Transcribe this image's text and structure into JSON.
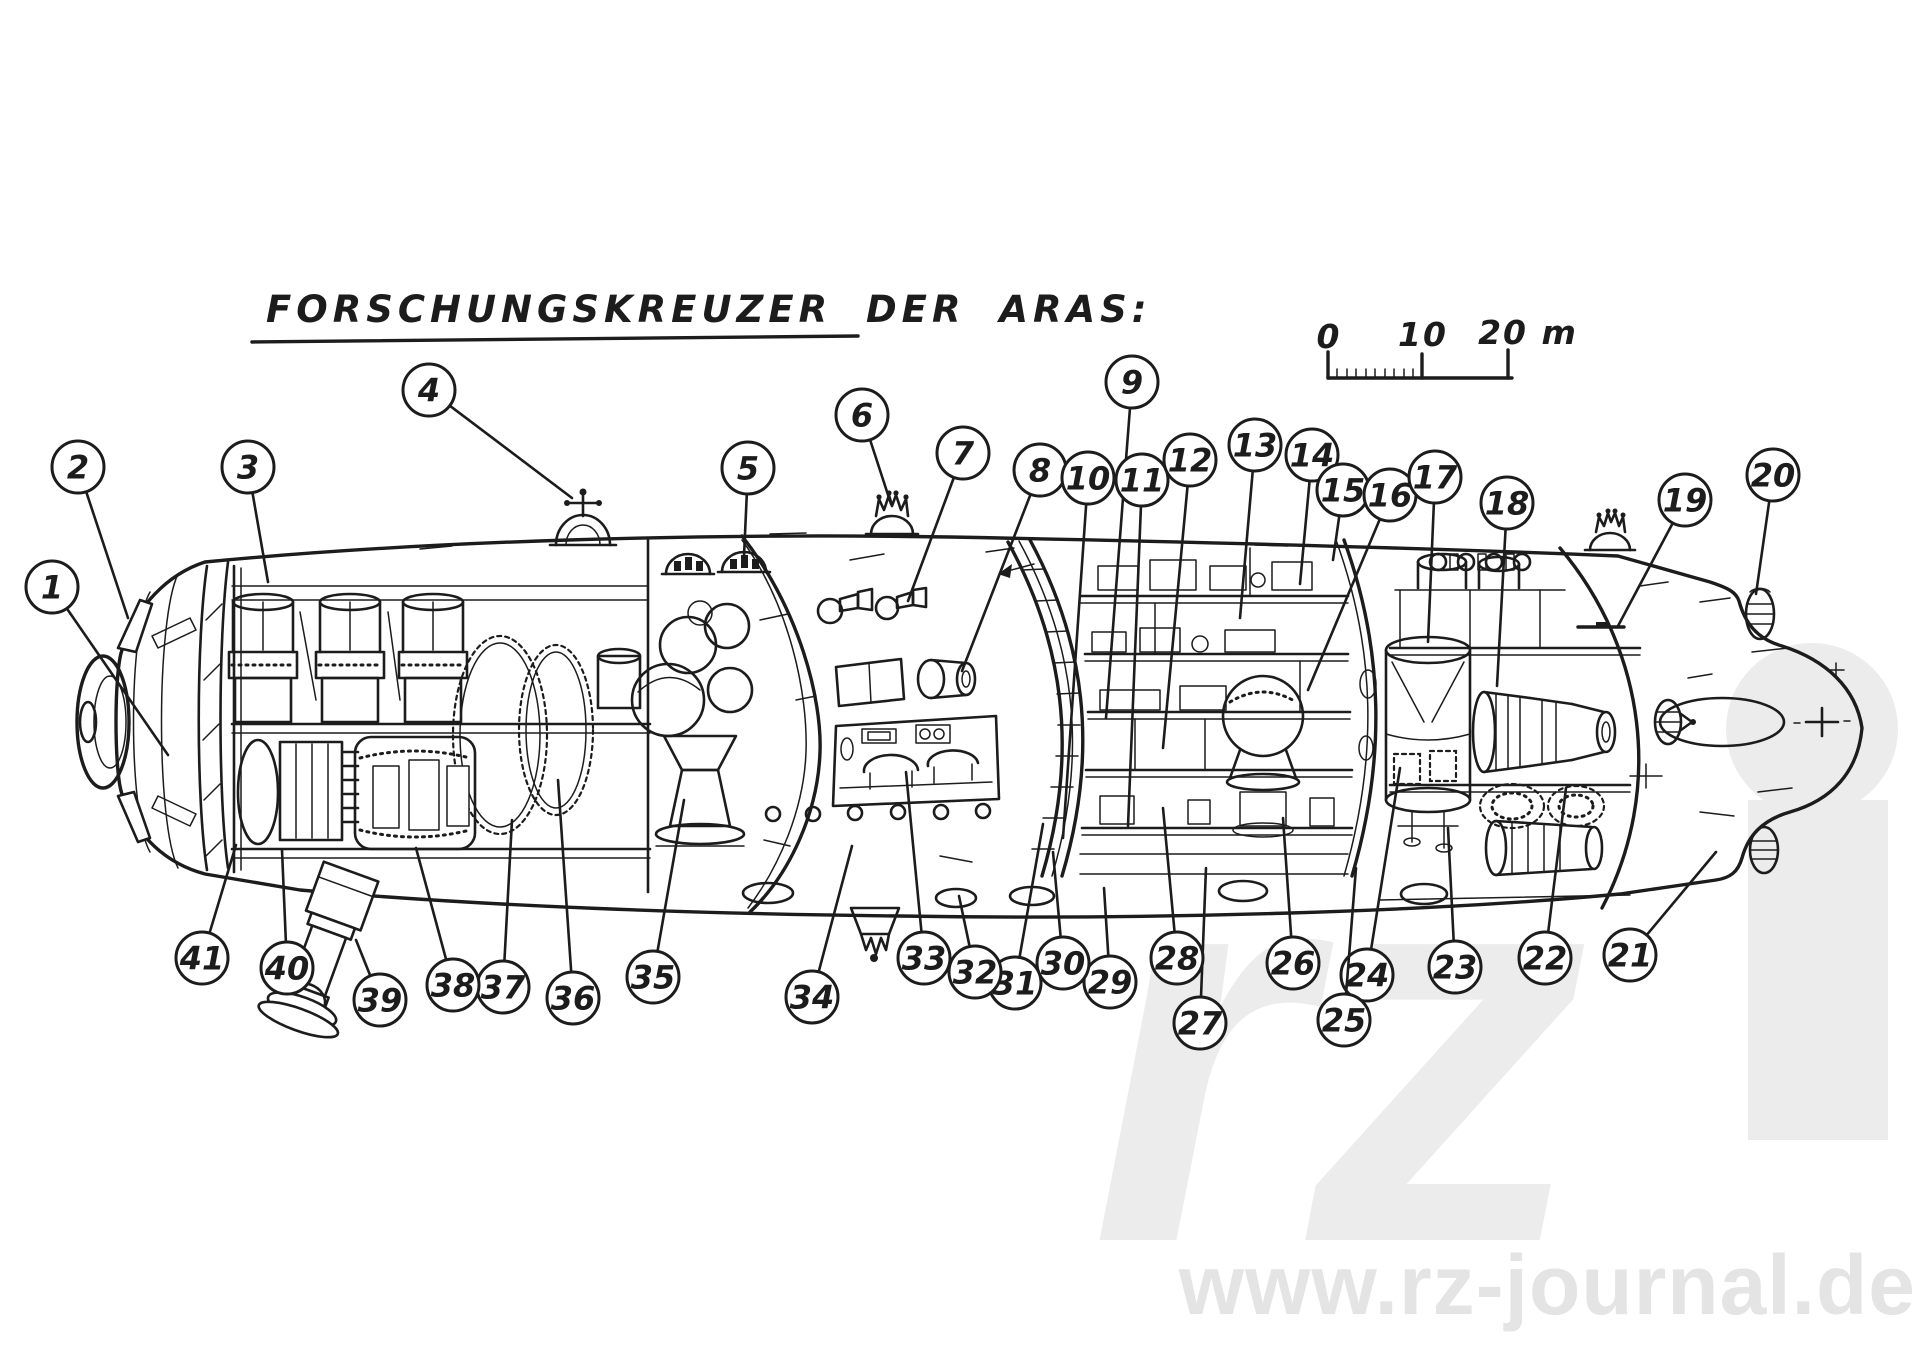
{
  "title": {
    "text": "FORSCHUNGSKREUZER DER ARAS:"
  },
  "scale_bar": {
    "tick_labels": [
      "0",
      "10",
      "20 m"
    ]
  },
  "watermark": {
    "site": "www.rz-journal.de",
    "monogram": "rz"
  },
  "colors": {
    "ink": "#1c1c1c",
    "paper": "#ffffff",
    "watermark_gray": "#ececec"
  },
  "callouts": [
    {
      "n": "1",
      "cx": 52,
      "cy": 587,
      "tx": 168,
      "ty": 755
    },
    {
      "n": "2",
      "cx": 78,
      "cy": 467,
      "tx": 128,
      "ty": 618
    },
    {
      "n": "3",
      "cx": 248,
      "cy": 467,
      "tx": 268,
      "ty": 582
    },
    {
      "n": "4",
      "cx": 429,
      "cy": 390,
      "tx": 572,
      "ty": 498
    },
    {
      "n": "5",
      "cx": 748,
      "cy": 468,
      "tx": 744,
      "ty": 556
    },
    {
      "n": "6",
      "cx": 862,
      "cy": 415,
      "tx": 891,
      "ty": 504
    },
    {
      "n": "7",
      "cx": 963,
      "cy": 453,
      "tx": 908,
      "ty": 601
    },
    {
      "n": "8",
      "cx": 1040,
      "cy": 470,
      "tx": 962,
      "ty": 671
    },
    {
      "n": "9",
      "cx": 1132,
      "cy": 382,
      "tx": 1106,
      "ty": 718
    },
    {
      "n": "10",
      "cx": 1088,
      "cy": 478,
      "tx": 1063,
      "ty": 838
    },
    {
      "n": "11",
      "cx": 1142,
      "cy": 480,
      "tx": 1128,
      "ty": 826
    },
    {
      "n": "12",
      "cx": 1190,
      "cy": 460,
      "tx": 1163,
      "ty": 748
    },
    {
      "n": "13",
      "cx": 1255,
      "cy": 445,
      "tx": 1240,
      "ty": 618
    },
    {
      "n": "14",
      "cx": 1312,
      "cy": 455,
      "tx": 1300,
      "ty": 584
    },
    {
      "n": "15",
      "cx": 1343,
      "cy": 490,
      "tx": 1333,
      "ty": 560
    },
    {
      "n": "16",
      "cx": 1390,
      "cy": 495,
      "tx": 1308,
      "ty": 690
    },
    {
      "n": "17",
      "cx": 1435,
      "cy": 477,
      "tx": 1428,
      "ty": 642
    },
    {
      "n": "18",
      "cx": 1507,
      "cy": 503,
      "tx": 1497,
      "ty": 686
    },
    {
      "n": "19",
      "cx": 1685,
      "cy": 500,
      "tx": 1618,
      "ty": 626
    },
    {
      "n": "20",
      "cx": 1773,
      "cy": 475,
      "tx": 1756,
      "ty": 594
    },
    {
      "n": "21",
      "cx": 1630,
      "cy": 955,
      "tx": 1716,
      "ty": 852
    },
    {
      "n": "22",
      "cx": 1545,
      "cy": 958,
      "tx": 1566,
      "ty": 788
    },
    {
      "n": "23",
      "cx": 1455,
      "cy": 967,
      "tx": 1448,
      "ty": 828
    },
    {
      "n": "24",
      "cx": 1367,
      "cy": 975,
      "tx": 1400,
      "ty": 768
    },
    {
      "n": "25",
      "cx": 1344,
      "cy": 1020,
      "tx": 1356,
      "ty": 868
    },
    {
      "n": "26",
      "cx": 1293,
      "cy": 963,
      "tx": 1283,
      "ty": 818
    },
    {
      "n": "27",
      "cx": 1200,
      "cy": 1023,
      "tx": 1206,
      "ty": 868
    },
    {
      "n": "28",
      "cx": 1177,
      "cy": 958,
      "tx": 1163,
      "ty": 808
    },
    {
      "n": "29",
      "cx": 1110,
      "cy": 982,
      "tx": 1104,
      "ty": 888
    },
    {
      "n": "30",
      "cx": 1063,
      "cy": 963,
      "tx": 1053,
      "ty": 852
    },
    {
      "n": "31",
      "cx": 1015,
      "cy": 983,
      "tx": 1043,
      "ty": 824
    },
    {
      "n": "32",
      "cx": 975,
      "cy": 972,
      "tx": 959,
      "ty": 896
    },
    {
      "n": "33",
      "cx": 924,
      "cy": 958,
      "tx": 906,
      "ty": 772
    },
    {
      "n": "34",
      "cx": 812,
      "cy": 997,
      "tx": 852,
      "ty": 846
    },
    {
      "n": "35",
      "cx": 653,
      "cy": 977,
      "tx": 684,
      "ty": 800
    },
    {
      "n": "36",
      "cx": 573,
      "cy": 998,
      "tx": 558,
      "ty": 780
    },
    {
      "n": "37",
      "cx": 503,
      "cy": 987,
      "tx": 512,
      "ty": 820
    },
    {
      "n": "38",
      "cx": 453,
      "cy": 985,
      "tx": 416,
      "ty": 848
    },
    {
      "n": "39",
      "cx": 380,
      "cy": 1000,
      "tx": 356,
      "ty": 940
    },
    {
      "n": "40",
      "cx": 287,
      "cy": 968,
      "tx": 282,
      "ty": 850
    },
    {
      "n": "41",
      "cx": 202,
      "cy": 958,
      "tx": 236,
      "ty": 845
    }
  ]
}
